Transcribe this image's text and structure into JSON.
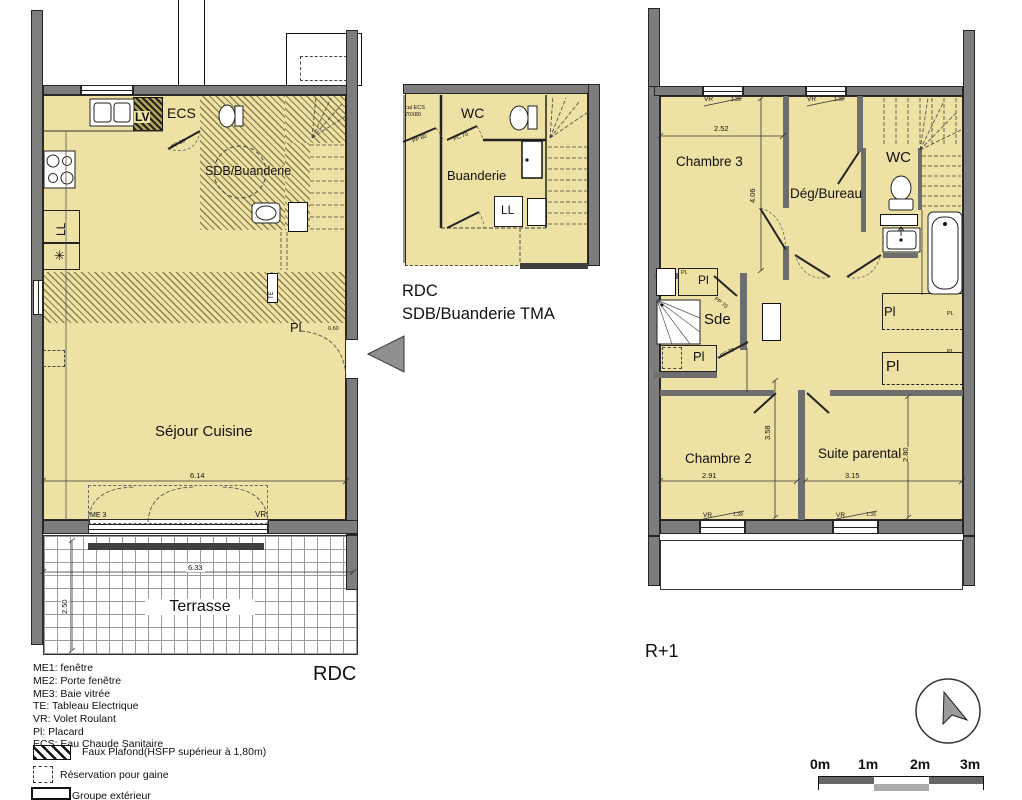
{
  "colors": {
    "floor": "#EDE2A3",
    "wall": "#7D7D7D",
    "dark_strip": "#3F3F3F"
  },
  "rdc": {
    "title": "RDC",
    "rooms": {
      "sejour": "Séjour Cuisine",
      "sdb": "SDB/Buanderie",
      "terrasse": "Terrasse"
    },
    "labels": {
      "lv": "LV",
      "ecs": "ECS",
      "ll": "LL",
      "te": "TE",
      "fridge": "✳",
      "pl": "Pl",
      "pl_dim": "0.60",
      "me3": "ME 3",
      "vr": "VR",
      "pp80": "PP 80"
    },
    "dims": {
      "sejour_w": "6.14",
      "terrasse_w": "6.33",
      "terrasse_d": "2.50"
    }
  },
  "tma": {
    "title_line1": "RDC",
    "title_line2": "SDB/Buanderie TMA",
    "rooms": {
      "wc": "WC",
      "buanderie": "Buanderie"
    },
    "labels": {
      "ll": "LL",
      "local_line1": "cal ECS",
      "local_line2": "70X80",
      "pp80": "PP 80",
      "pc70": "PC 70"
    }
  },
  "r1": {
    "title": "R+1",
    "rooms": {
      "chambre3": "Chambre 3",
      "deg_bureau": "Dég/Bureau",
      "wc": "WC",
      "sde": "Sde",
      "chambre2": "Chambre 2",
      "suite": "Suite parentale"
    },
    "labels": {
      "vr": "VR",
      "vr_dim": "1.39",
      "pl": "Pl",
      "pl_small": "PL",
      "pp70": "PP 70"
    },
    "dims": {
      "chambre3_w": "2.52",
      "chambre3_h": "4.06",
      "chambre2_w": "2.91",
      "chambre2_h": "3.58",
      "suite_w": "3.15",
      "suite_h": "2.80"
    }
  },
  "legend": {
    "items": [
      "ME1: fenêtre",
      "ME2: Porte fenêtre",
      "ME3: Baie vitrée",
      "TE: Tableau Electrique",
      "VR: Volet Roulant",
      "Pl: Placard",
      "ECS: Eau Chaude Sanitaire"
    ],
    "faux_plafond": "Faux Plafond(HSFP supérieur à 1,80m)",
    "reservation": "Réservation pour gaine",
    "groupe": "Groupe extérieur"
  },
  "scale_bar": {
    "m0": "0m",
    "m1": "1m",
    "m2": "2m",
    "m3": "3m"
  }
}
